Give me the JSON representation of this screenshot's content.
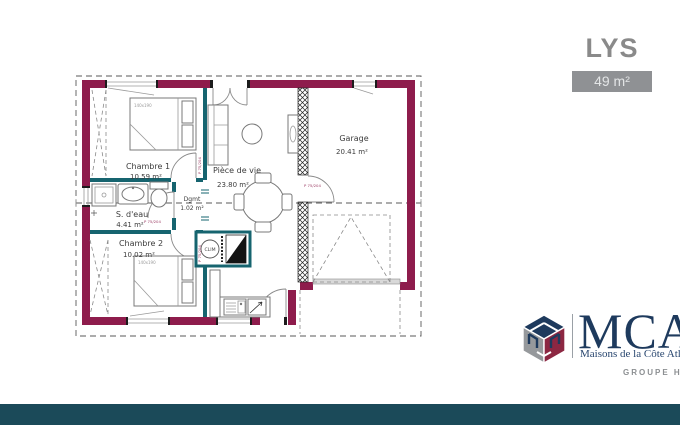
{
  "header": {
    "title": "LYS",
    "area_badge": "49 m²"
  },
  "plan": {
    "rooms": {
      "chambre1": {
        "name": "Chambre 1",
        "area": "10.59 m²"
      },
      "sdeau": {
        "name": "S. d'eau",
        "area": "4.41 m²"
      },
      "chambre2": {
        "name": "Chambre 2",
        "area": "10.02 m²"
      },
      "piece_de_vie": {
        "name": "Pièce de vie",
        "area": "23.80 m²"
      },
      "dgmt": {
        "name": "Dgmt",
        "area": "1.02 m²"
      },
      "garage": {
        "name": "Garage",
        "area": "20.41 m²"
      }
    },
    "annotations": {
      "clim": "CLIM",
      "bed_size": "140x190",
      "door_label": "P 75/204"
    },
    "colors": {
      "exterior_wall": "#8e1c4c",
      "interior_wall": "#16646f"
    }
  },
  "logo": {
    "brand": "MCA",
    "tagline": "Maisons de la Côte Atlantique",
    "group": "GROUPE Hexaôm",
    "colors": {
      "navy": "#1e3a5d",
      "gray": "#96999c",
      "red": "#8c2742"
    }
  },
  "footer": {
    "bar_color": "#1b4a59"
  }
}
